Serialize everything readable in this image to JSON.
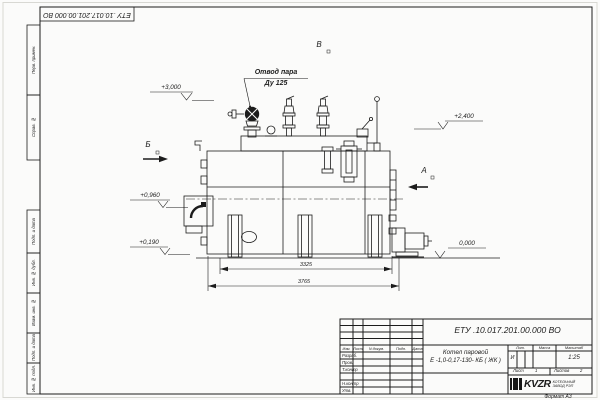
{
  "doc": {
    "stamp_top": "ЕТУ .10.017.201.00.000  ВО",
    "format_note": "Формат А3"
  },
  "margin_stamps": {
    "perv_primen": "Перв. примен.",
    "sprav_no": "Справ. №",
    "podp_data_1": "Подп. и дата",
    "inv_dubl": "Инв. № дубл.",
    "vzam_inv": "Взам. инв. №",
    "podp_data_2": "Подп. и дата",
    "inv_podl": "Инв. № подл."
  },
  "drawing": {
    "view_top": "В",
    "view_left": "Б",
    "view_right": "А",
    "callout_line1": "Отвод пара",
    "callout_line2": "Ду 125",
    "elev_3000": "+3,000",
    "elev_2400": "+2,400",
    "elev_0960": "+0,960",
    "elev_0190": "+0,190",
    "elev_0000": "0,000",
    "dim_inner": "3325",
    "dim_outer": "3765"
  },
  "title_block": {
    "doc_number": "ЕТУ .10.017.201.00.000  ВО",
    "name_line1": "Котел паровой",
    "name_line2": "Е -1,0-0,17-130- КБ ( ЖК )",
    "col_izm": "Изм.",
    "col_list": "Лист",
    "col_doc": "N докум.",
    "col_podp": "Подп.",
    "col_data": "Дата",
    "row_razrab": "Разраб.",
    "row_prov": "Пров.",
    "row_tkontr": "Т.контр",
    "row_nkontr": "Н.контр",
    "row_utv": "Утв.",
    "lit_header": "Лит.",
    "mass_header": "Масса",
    "scale_header": "Масштаб",
    "lit_value": "И",
    "scale_value": "1:25",
    "sheet_label": "Лист",
    "sheet_value": "1",
    "sheets_label": "Листов",
    "sheets_value": "2",
    "logo_text": "KVZR",
    "logo_sub1": "КОТЕЛЬНЫЙ",
    "logo_sub2": "ЗАВОД РЭП"
  },
  "colors": {
    "line": "#1c1c1c",
    "paper": "#fbfbfa"
  }
}
